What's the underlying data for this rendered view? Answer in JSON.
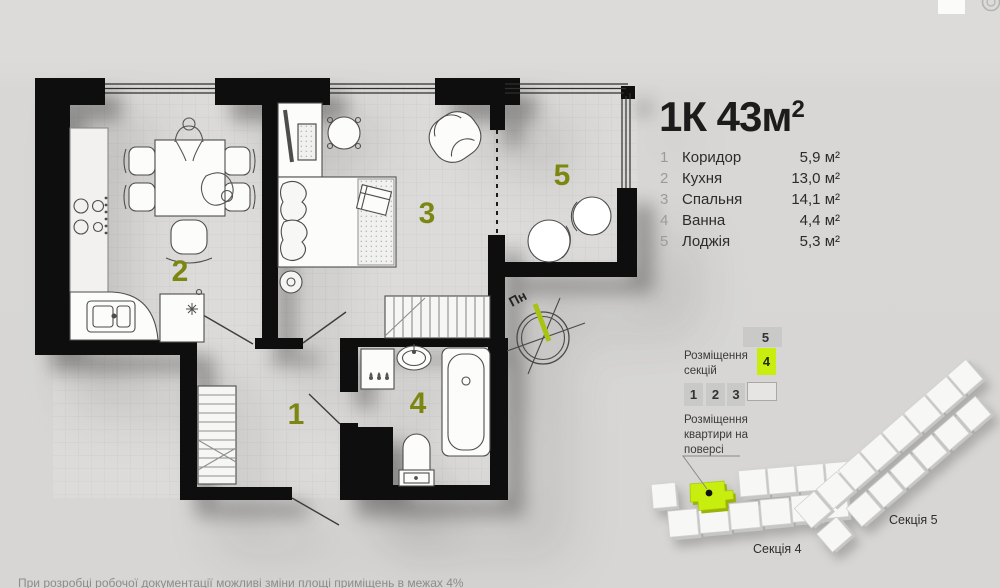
{
  "header": {
    "title_main": "1К 43м",
    "title_sup": "2"
  },
  "legend": {
    "rows": [
      {
        "num": "1",
        "name": "Коридор",
        "area": "5,9 м²"
      },
      {
        "num": "2",
        "name": "Кухня",
        "area": "13,0 м²"
      },
      {
        "num": "3",
        "name": "Спальня",
        "area": "14,1 м²"
      },
      {
        "num": "4",
        "name": "Ванна",
        "area": "4,4 м²"
      },
      {
        "num": "5",
        "name": "Лоджія",
        "area": "5,3 м²"
      }
    ]
  },
  "plan": {
    "room_numbers": [
      "1",
      "2",
      "3",
      "4",
      "5"
    ],
    "north_label": "Пн"
  },
  "section_widget": {
    "label": "Розміщення секцій",
    "box5": "5",
    "box4": "4",
    "row": [
      "1",
      "2",
      "3"
    ]
  },
  "floor_widget": {
    "label": "Розміщення квартири на поверсі"
  },
  "sections_3d": {
    "section4_label": "Секція 4",
    "section5_label": "Секція 5"
  },
  "footer": {
    "disclaimer": "При розробці робочої документації можливі зміни площі приміщень в межах 4%"
  },
  "colors": {
    "accent_lime": "#c7ee0e",
    "room_number_olive": "#7c8712",
    "wall_black": "#0e0e0e",
    "background": "#d8d7d5"
  }
}
